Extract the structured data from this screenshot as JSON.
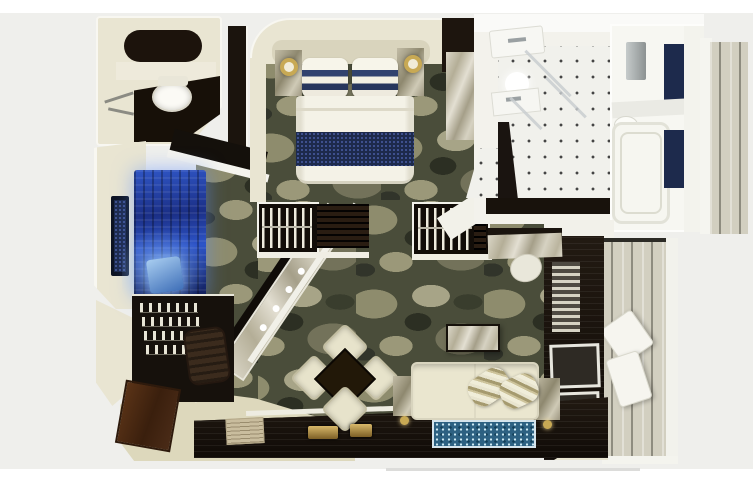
{
  "meta": {
    "type": "3d-rendered-floor-plan",
    "subject": "Top-down 3D rendering of a luxury suite floor plan",
    "visible_text": "none"
  },
  "palette": {
    "page_bg": "#ffffff",
    "canvas_bg": "#efefec",
    "wall_cream": "#e9e5d2",
    "floor_cream": "#ddd8bc",
    "carpet_olive": "#4a4d3a",
    "carpet_light": "#a7a487",
    "dark_wood": "#1c140d",
    "near_black": "#120d08",
    "navy": "#1d2a4c",
    "panel_blue": "#2144b0",
    "glow_blue": "#9cc9ff",
    "tile_white": "#f1f1ec",
    "tile_dot": "#454545",
    "marble_light": "#d9d5c6",
    "marble_shadow": "#a59f89",
    "plank_gray": "#d2cfc0",
    "sofa_cream": "#eae6cf",
    "rug_teal": "#2d6182",
    "cabinet_brown": "#4a2b17",
    "brass_gold": "#c8a954",
    "rug_beige": "#c9bd9e",
    "fixture_gray": "#9aa0a2",
    "lounger_white": "#f6f5ef"
  },
  "rooms": [
    {
      "id": "guest-bathroom",
      "position": "top-left"
    },
    {
      "id": "master-bedroom",
      "position": "top-center"
    },
    {
      "id": "master-bathroom",
      "position": "top-right-center"
    },
    {
      "id": "tub-room",
      "position": "top-right"
    },
    {
      "id": "dressing-lounge-bar",
      "position": "left"
    },
    {
      "id": "living-dining-room",
      "position": "center"
    },
    {
      "id": "entry-hall",
      "position": "bottom-left"
    },
    {
      "id": "side-balcony",
      "position": "far-right-top"
    },
    {
      "id": "main-balcony",
      "position": "right"
    }
  ]
}
